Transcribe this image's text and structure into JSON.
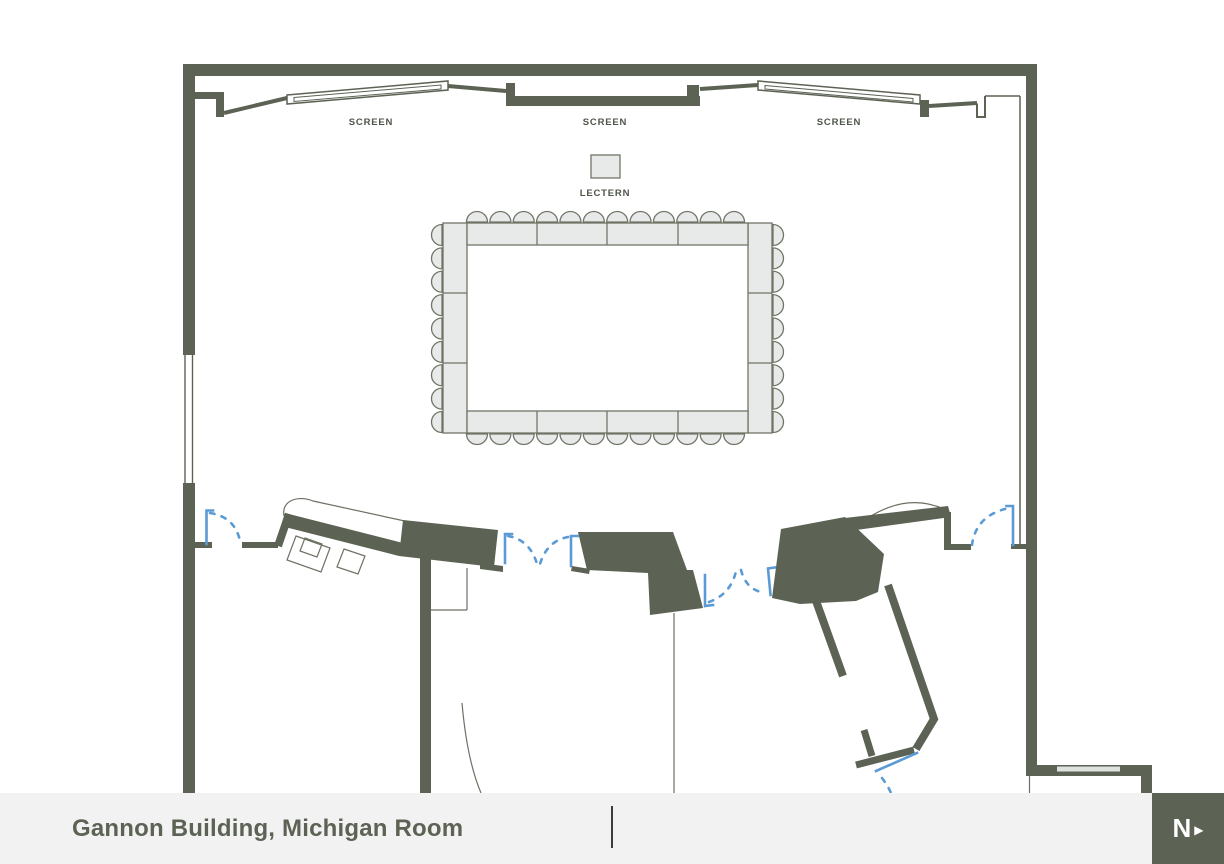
{
  "floor_plan": {
    "room_name": "Gannon Building, Michigan Room",
    "labels": {
      "lectern": "LECTERN"
    },
    "screens": [
      {
        "position": "left",
        "label": "SCREEN"
      },
      {
        "position": "center",
        "label": "SCREEN"
      },
      {
        "position": "right",
        "label": "SCREEN"
      }
    ],
    "furniture": {
      "lectern_count": 1,
      "screen_count": 3,
      "conference_table": {
        "type": "hollow-square",
        "top_row_segments": 4,
        "bottom_row_segments": 4,
        "left_column_segments": 3,
        "right_column_segments": 3,
        "chairs_top": 12,
        "chairs_bottom": 12,
        "chairs_left": 9,
        "chairs_right": 9,
        "total_chairs": 42
      }
    },
    "colors": {
      "wall": "#5c6354",
      "furniture_fill": "#e8eaea",
      "furniture_stroke": "#6f7566",
      "door": "#5b9bd5",
      "label_text": "#4e5549",
      "footer_bg": "#f2f2f2",
      "footer_text": "#5c6354",
      "divider": "#3c3c3c",
      "thin": "#6b7263"
    }
  },
  "footer": {
    "title": "Gannon Building, Michigan Room"
  },
  "north_indicator": {
    "letter": "N",
    "arrow": "▶"
  }
}
